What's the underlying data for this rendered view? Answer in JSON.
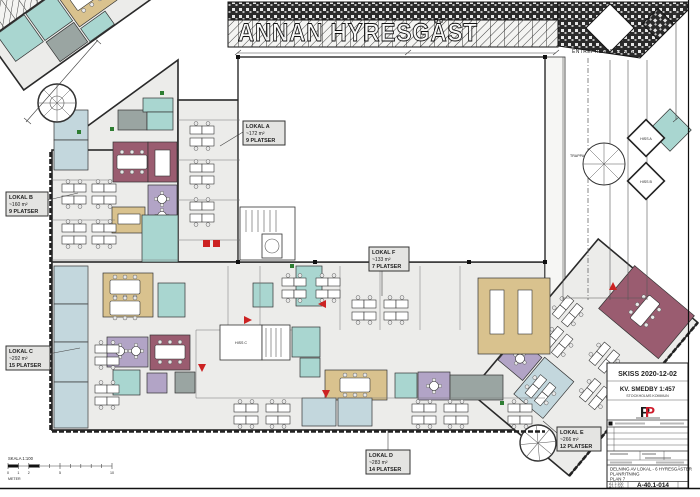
{
  "drawing": {
    "neighbor_label": "ANNAN HYRESGÄST",
    "boundary_label": "ENTREPRENADGRÄNS"
  },
  "scale_bar": {
    "title": "SKALA 1:100",
    "unit": "METER",
    "ticks": [
      "0",
      "1",
      "2",
      "5",
      "10"
    ]
  },
  "cores": {
    "hiss_a": "HISS A",
    "hiss_b": "HISS B",
    "hiss_c": "HISS C",
    "trappa": "TRAPPA"
  },
  "locals": [
    {
      "name": "LOKAL A",
      "area": "~172 m²",
      "seats": "9 PLATSER"
    },
    {
      "name": "LOKAL B",
      "area": "~160 m²",
      "seats": "9 PLATSER"
    },
    {
      "name": "LOKAL C",
      "area": "~292 m²",
      "seats": "15 PLATSER"
    },
    {
      "name": "LOKAL D",
      "area": "~283 m²",
      "seats": "14 PLATSER"
    },
    {
      "name": "LOKAL E",
      "area": "~266 m²",
      "seats": "12 PLATSER"
    },
    {
      "name": "LOKAL F",
      "area": "~133 m²",
      "seats": "7 PLATSER"
    }
  ],
  "title_block": {
    "sketch_label": "SKISS 2020-12-02",
    "property": "KV. SMEDBY 1:457",
    "municipality": "STOCKHOLMS KOMMUN",
    "logo_letter": "P",
    "description_line1": "DELNING AV LOKAL - 6 HYRESGÄSTER",
    "description_line2": "PLANRITNING",
    "description_line3": "PLAN 7",
    "scale_a1": "A1 1:100",
    "scale_a3": "A3 1:200",
    "drawing_number": "A-40.1-014"
  },
  "colors": {
    "wall": "#1a1a1a",
    "floor": "#ececea",
    "teal": "#a9d6d0",
    "plum": "#9a5c70",
    "lavender": "#b2a4c6",
    "tan": "#d9c28e",
    "light_blue": "#c3d7dd",
    "gray": "#9aa5a2",
    "accent_red": "#cc2222",
    "door_green": "#2e7d32",
    "logo_red": "#cf1b2b"
  }
}
